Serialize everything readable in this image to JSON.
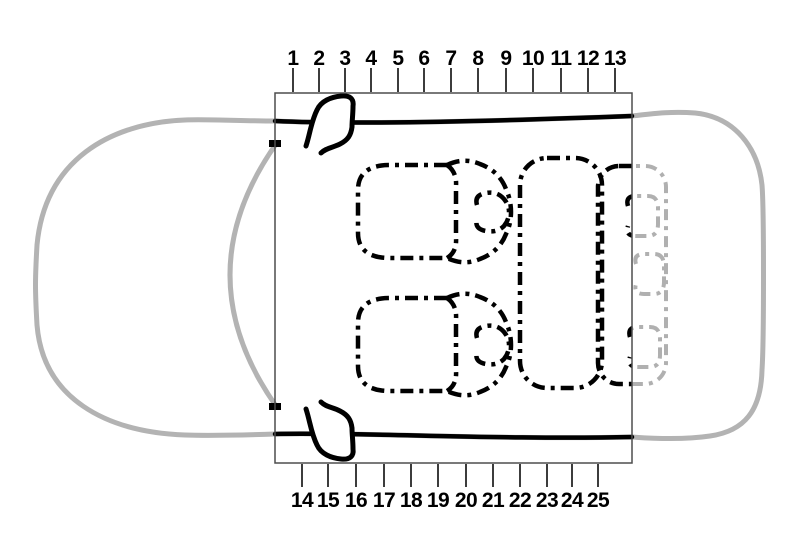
{
  "scales": {
    "top": {
      "labels": [
        "1",
        "2",
        "3",
        "4",
        "5",
        "6",
        "7",
        "8",
        "9",
        "10",
        "11",
        "12",
        "13"
      ]
    },
    "bottom": {
      "labels": [
        "14",
        "15",
        "16",
        "17",
        "18",
        "19",
        "20",
        "21",
        "22",
        "23",
        "24",
        "25"
      ]
    }
  },
  "colors": {
    "ink": "#000000",
    "car_outline": "#b3b3b3",
    "ghost_seat": "#b0b0b0",
    "frame": "#4d4d4d",
    "tick": "#3c3c3c"
  }
}
